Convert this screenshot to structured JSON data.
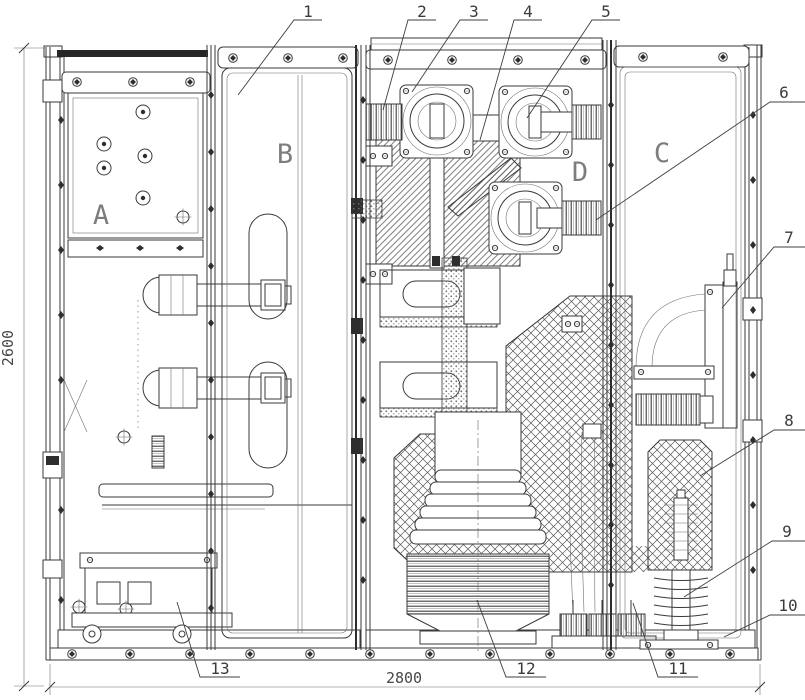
{
  "drawing": {
    "dimensions": {
      "height_mm": "2600",
      "width_mm": "2800"
    },
    "compartments": [
      {
        "label": "A"
      },
      {
        "label": "B"
      },
      {
        "label": "C"
      },
      {
        "label": "D"
      }
    ],
    "callouts": [
      {
        "number": "1"
      },
      {
        "number": "2"
      },
      {
        "number": "3"
      },
      {
        "number": "4"
      },
      {
        "number": "5"
      },
      {
        "number": "6"
      },
      {
        "number": "7"
      },
      {
        "number": "8"
      },
      {
        "number": "9"
      },
      {
        "number": "10"
      },
      {
        "number": "11"
      },
      {
        "number": "12"
      },
      {
        "number": "13"
      }
    ],
    "colors": {
      "line": "#3a3a3a",
      "hatch": "#5f5f5f",
      "label_text": "#7d7d7d",
      "callout_text": "#3b3b3b",
      "background": "#ffffff"
    }
  }
}
